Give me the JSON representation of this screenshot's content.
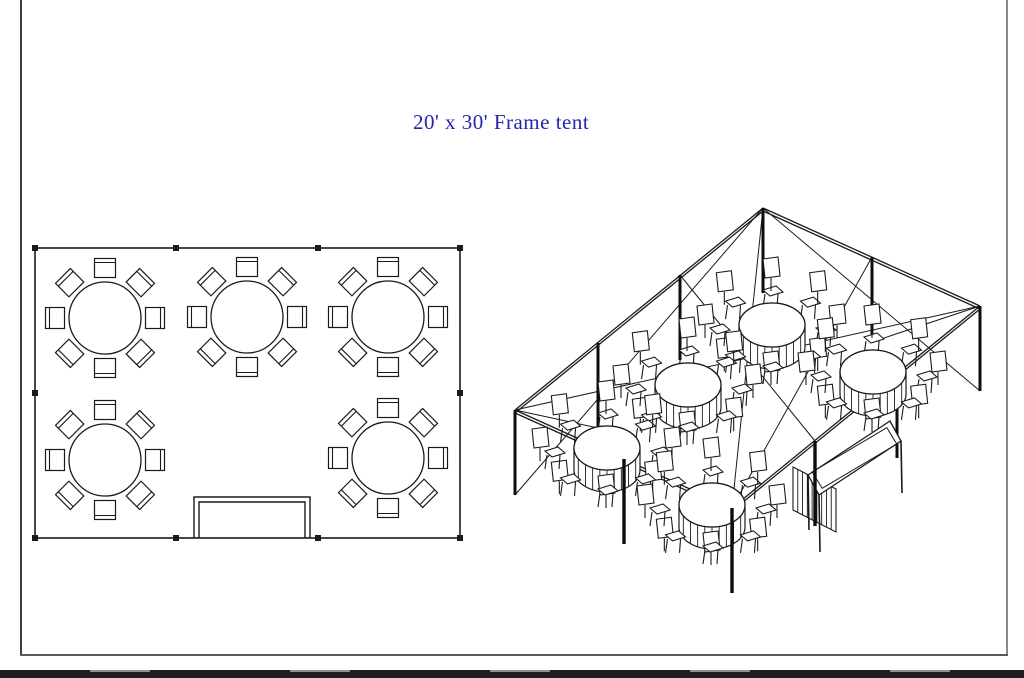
{
  "page": {
    "background": "#ffffff",
    "border_color_left": "#3d3d3d",
    "border_color_right": "#8a8a8a",
    "border_color_bottom": "#5a5a5a",
    "bottom_bar_color": "#1f1f1f"
  },
  "title": {
    "text": "20' x 30' Frame tent",
    "color": "#2525ad"
  },
  "plan_view": {
    "line_color": "#1a1a1a",
    "tent": {
      "x": 35,
      "y": 248,
      "width": 425,
      "height": 290
    },
    "pole_markers": [
      [
        35,
        248
      ],
      [
        176,
        248
      ],
      [
        318,
        248
      ],
      [
        460,
        248
      ],
      [
        35,
        393
      ],
      [
        460,
        393
      ],
      [
        35,
        538
      ],
      [
        176,
        538
      ],
      [
        318,
        538
      ],
      [
        460,
        538
      ]
    ],
    "marker_size": 6,
    "round_tables": [
      [
        105,
        318
      ],
      [
        247,
        317
      ],
      [
        388,
        317
      ],
      [
        105,
        460
      ],
      [
        388,
        458
      ]
    ],
    "table_radius": 36,
    "chairs_per_table": 8,
    "chair": {
      "w": 21,
      "h": 19,
      "dist": 50,
      "back_inset": 4
    },
    "buffet_table": {
      "x": 194,
      "y": 497,
      "width": 116,
      "height": 41,
      "inset": 5
    }
  },
  "iso_view": {
    "line_color": "#1a1a1a",
    "pole_length": 85,
    "pole_tops_far": [
      [
        515,
        410
      ],
      [
        598,
        343
      ],
      [
        680,
        275
      ],
      [
        763,
        208
      ],
      [
        872,
        257
      ],
      [
        980,
        306
      ],
      [
        897,
        373
      ]
    ],
    "pole_tops_near": [
      [
        815,
        441
      ],
      [
        624,
        459
      ],
      [
        732,
        508
      ]
    ],
    "eave_edges": [
      [
        [
          515,
          410
        ],
        [
          763,
          208
        ]
      ],
      [
        [
          763,
          208
        ],
        [
          980,
          306
        ]
      ],
      [
        [
          515,
          410
        ],
        [
          732,
          508
        ]
      ],
      [
        [
          732,
          508
        ],
        [
          980,
          306
        ]
      ]
    ],
    "cables": [
      [
        [
          763,
          208
        ],
        [
          732,
          508
        ]
      ],
      [
        [
          515,
          410
        ],
        [
          980,
          306
        ]
      ],
      [
        [
          763,
          208
        ],
        [
          515,
          495
        ]
      ],
      [
        [
          763,
          208
        ],
        [
          980,
          391
        ]
      ],
      [
        [
          980,
          306
        ],
        [
          872,
          342
        ]
      ],
      [
        [
          515,
          410
        ],
        [
          598,
          428
        ]
      ],
      [
        [
          872,
          257
        ],
        [
          732,
          508
        ]
      ],
      [
        [
          680,
          275
        ],
        [
          815,
          441
        ]
      ]
    ],
    "round_tables": [
      [
        772,
        325
      ],
      [
        873,
        372
      ],
      [
        688,
        385
      ],
      [
        607,
        448
      ],
      [
        712,
        505
      ]
    ],
    "table_rx": 33,
    "table_ry": 22,
    "skirt_drop": 22,
    "chairs_per_table": 8,
    "rect_table": {
      "top_face": [
        [
          808,
          475
        ],
        [
          890,
          421
        ],
        [
          901,
          441
        ],
        [
          819,
          495
        ]
      ],
      "top_inset": 3,
      "legs": [
        [
          819,
          495,
          57
        ],
        [
          808,
          475,
          55
        ],
        [
          901,
          441,
          52
        ],
        [
          890,
          421,
          27
        ]
      ],
      "skirt": {
        "x1": 793,
        "y1": 467,
        "x2": 836,
        "y2": 489,
        "drop": 43,
        "stripes": 9
      }
    }
  }
}
